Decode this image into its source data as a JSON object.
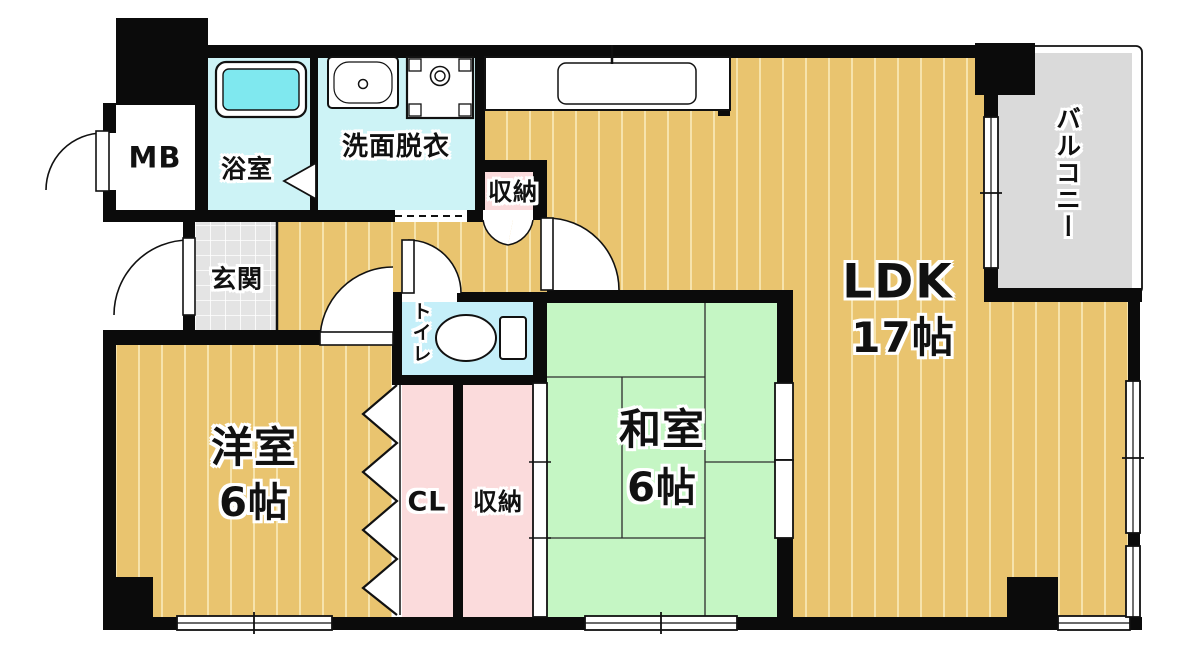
{
  "plan": {
    "type": "apartment-floorplan",
    "rooms": {
      "mb": {
        "label": "MB"
      },
      "bathroom": {
        "label": "浴室"
      },
      "washroom": {
        "label": "洗面脱衣"
      },
      "hall_storage": {
        "label": "収納"
      },
      "entrance": {
        "label": "玄関"
      },
      "toilet": {
        "label": "トイレ"
      },
      "closet": {
        "label": "CL"
      },
      "tatami_storage": {
        "label": "収納"
      },
      "western_room": {
        "label": "洋室",
        "size": "6帖"
      },
      "japanese_room": {
        "label": "和室",
        "size": "6帖"
      },
      "ldk": {
        "label": "LDK",
        "size": "17帖"
      },
      "balcony": {
        "label": "バルコニー"
      }
    },
    "colors": {
      "wood_floor": "#e9c46f",
      "wood_stripe": "#f6e3ac",
      "tatami_green": "#c5f6c4",
      "wet_area_cyan": "#cdf3f6",
      "toilet_cyan": "#c5eff9",
      "bathtub_cyan": "#7fe8ef",
      "closet_pink": "#fbdbdc",
      "entrance_tile": "#e4e4e4",
      "balcony_gray": "#dadada",
      "wall_black": "#0b0b0b"
    },
    "fixtures": [
      "bathtub",
      "vanity-sink",
      "washing-machine",
      "kitchen-counter",
      "kitchen-sink",
      "toilet-bowl"
    ]
  }
}
